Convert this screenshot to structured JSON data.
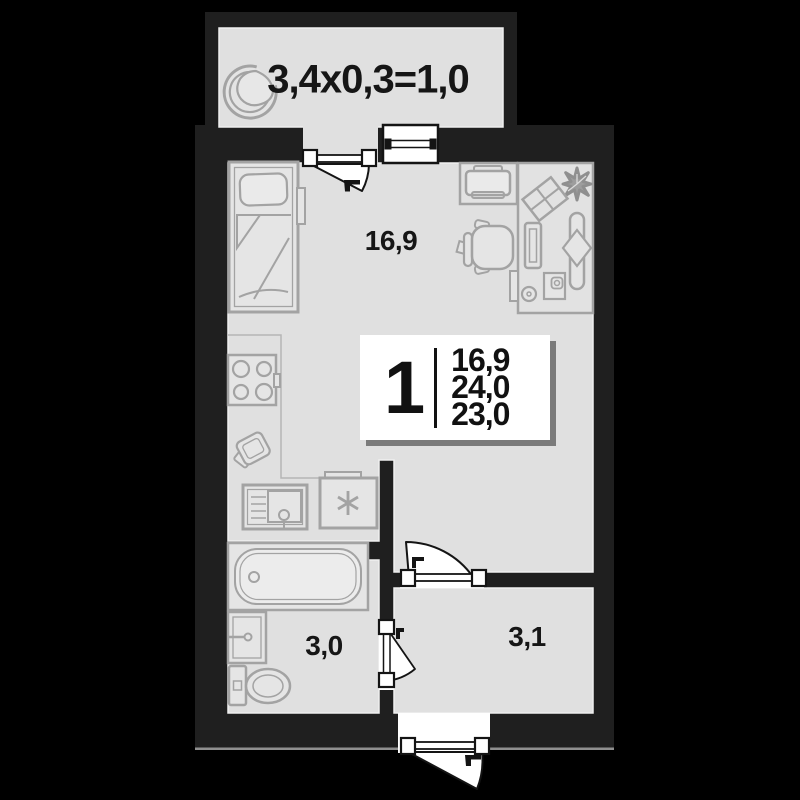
{
  "balcony": {
    "dimensions_label": "3,4x0,3=1,0"
  },
  "rooms": {
    "living": {
      "area": "16,9"
    },
    "bathroom": {
      "area": "3,0"
    },
    "hallway": {
      "area": "3,1"
    }
  },
  "info_card": {
    "room_count": "1",
    "areas": [
      "16,9",
      "24,0",
      "23,0"
    ]
  },
  "colors": {
    "background": "#000000",
    "wall": "#1f1f1f",
    "floor": "#e0e0e0",
    "furniture_line": "#a3a3a3",
    "text": "#161616",
    "door_window": "#ffffff",
    "outline": "#141414"
  },
  "icons": {
    "furniture": [
      "armchair-icon",
      "bed-icon",
      "stove-icon",
      "kitchen-sink-icon",
      "washing-machine-icon",
      "fridge-icon",
      "bathtub-icon",
      "washbasin-icon",
      "toilet-icon",
      "printer-icon",
      "desk-icon",
      "office-chair-icon",
      "monitor-icon",
      "plant-icon",
      "picture-frame-icon",
      "board-icon",
      "mouse-icon",
      "desk-accessory-icon",
      "balcony-door-icon",
      "window-icon",
      "interior-door-icon",
      "bathroom-door-icon",
      "entrance-door-icon"
    ]
  }
}
